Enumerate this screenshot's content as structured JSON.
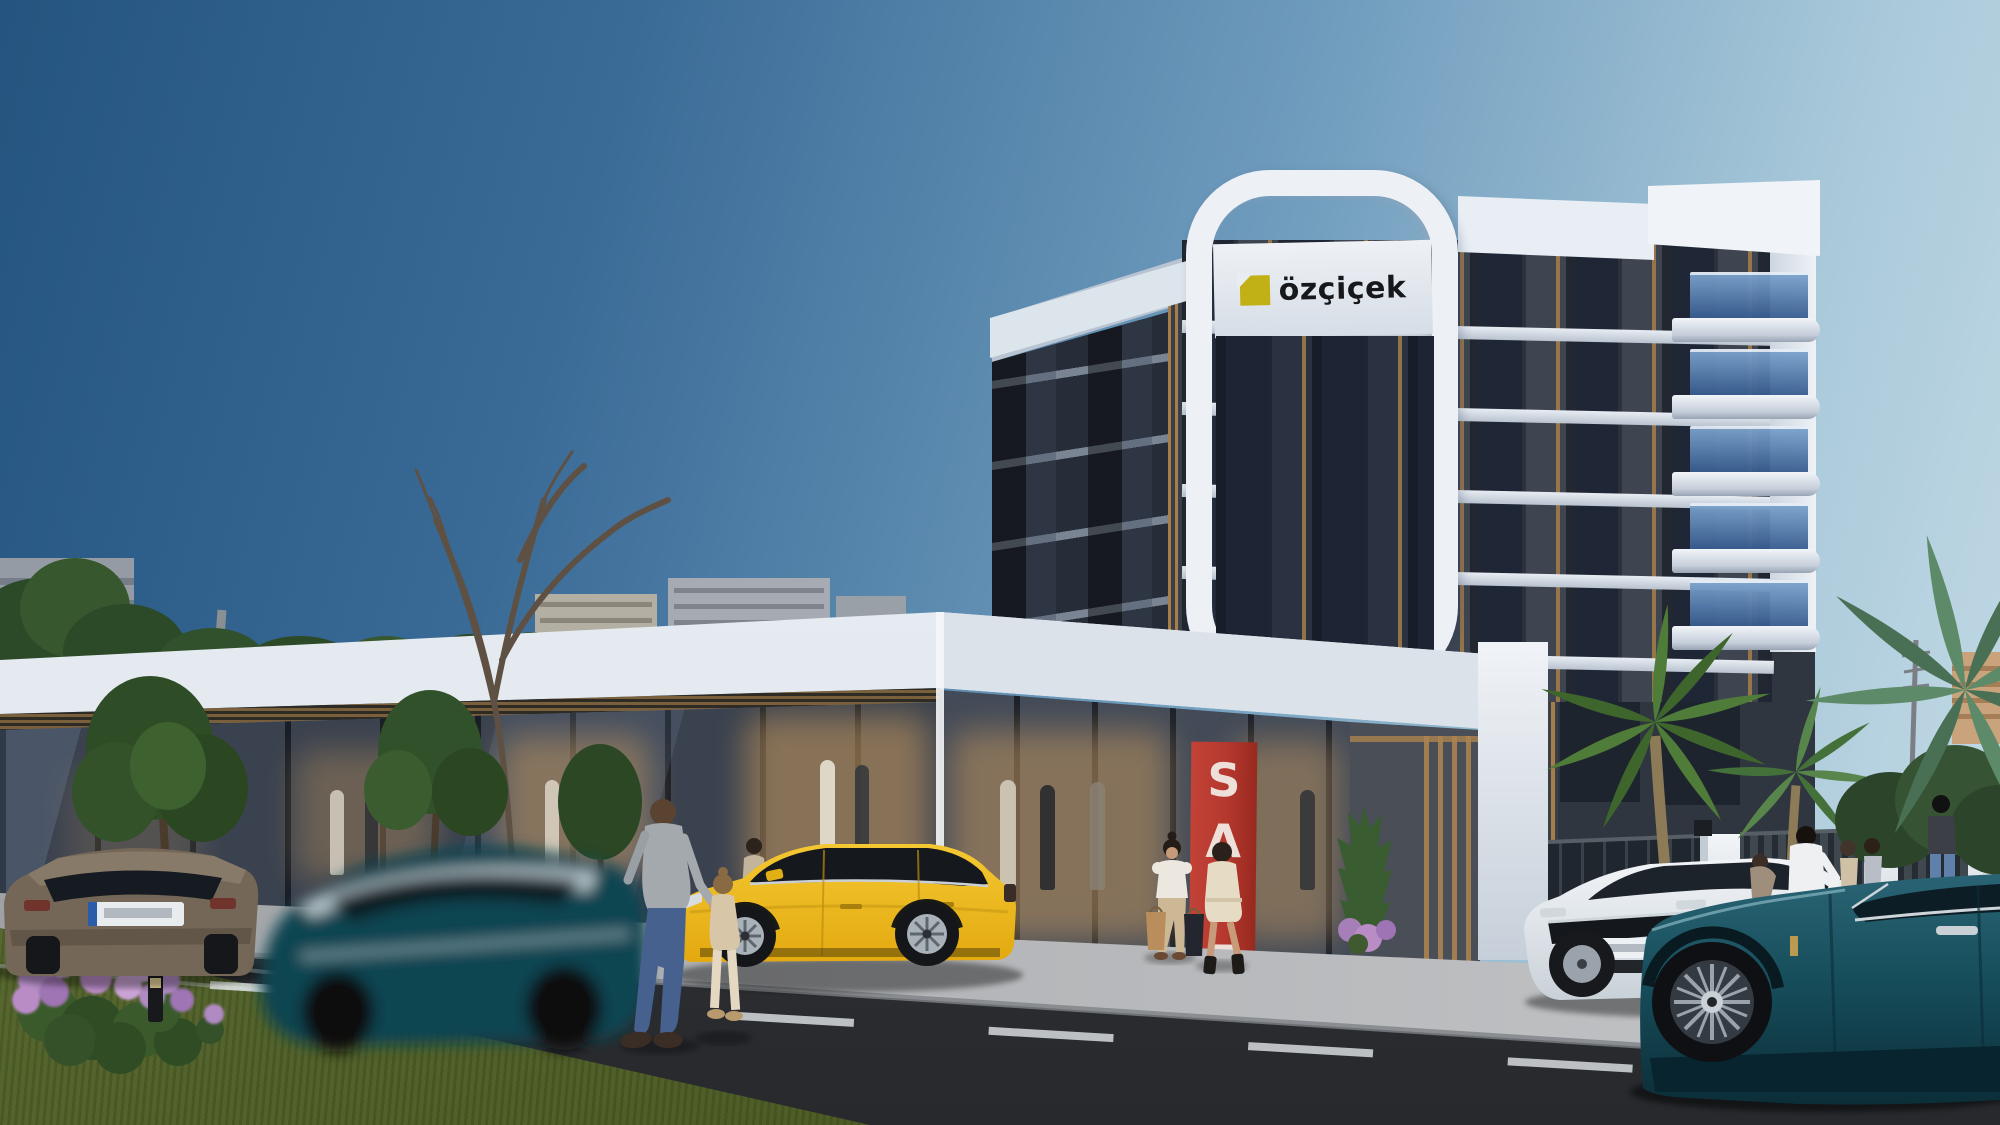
{
  "branding": {
    "logo_text": "özçiçek"
  },
  "store": {
    "sale_banner": {
      "letters": [
        "S",
        "A",
        "L",
        "E"
      ]
    }
  },
  "palette": {
    "sky_top": "#24547f",
    "sky_horizon": "#c6dbe6",
    "facade_dark": "#3e4551",
    "facade_shadow": "#272d38",
    "white_trim": "#edf1f6",
    "balcony_glass": "#41699f",
    "wood_accent": "#a57e48",
    "logo_yellow": "#c1b117",
    "logo_text_color": "#17181c",
    "sale_red": "#b5382e",
    "sale_letter": "#f3efe8",
    "glass_store": "#3a424f",
    "interior_glow": "#c99a5e",
    "plaza": "#b2b4b7",
    "road": "#35373b",
    "grass": "#57682f"
  }
}
